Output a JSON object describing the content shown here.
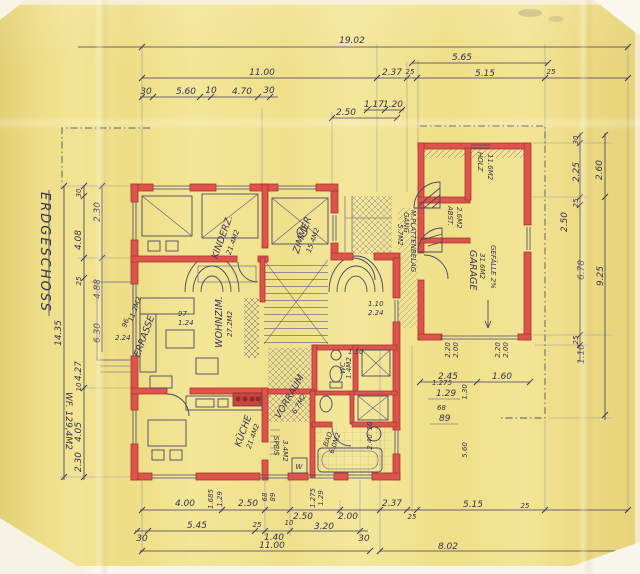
{
  "title": {
    "floor_label": "ERDGESCHOSS",
    "living_area": "WF. 129,4M2"
  },
  "rooms": {
    "kinderz": {
      "name": "KINDERZ.",
      "area": "21.4M2"
    },
    "zimmer": {
      "name": "ZIMMER",
      "area": "15.4M2"
    },
    "wohnzim": {
      "name": "WOHNZIM.",
      "area": "27.2M2"
    },
    "terrasse": {
      "name": "TERRASSE",
      "area": "11.2M2"
    },
    "kueche": {
      "name": "KÜCHE",
      "area": "21.4M2"
    },
    "speis": {
      "name": "SPEIS",
      "area": "3.4M2"
    },
    "vorraum": {
      "name": "VORRAUM",
      "area": "6.7M2"
    },
    "wc": {
      "name": "WC",
      "area": "1.4M2"
    },
    "bad": {
      "name": "BAD",
      "area": "6.0M2"
    },
    "holz": {
      "name": "HOLZ",
      "area": "11.6M2"
    },
    "abst": {
      "name": "ABST.",
      "area": "2.6M2"
    },
    "garage": {
      "name": "GARAGE",
      "area": "31.6M2",
      "slope": "GEFÄLLE 2%"
    },
    "gang": {
      "name": "GANG",
      "note": "M.PLATTENBELAG",
      "area": "5.7M2"
    },
    "washer_label": "W"
  },
  "dims": {
    "top": {
      "total": "19.02",
      "seg1": "11.00",
      "seg2": "2.37",
      "seg3": "25",
      "upper": "5.65",
      "seg4": "5.15",
      "seg5": "25",
      "sub": [
        "30",
        "5.60",
        "10",
        "4.70",
        "30"
      ],
      "sub2": [
        "1.17",
        "1.20"
      ],
      "porch": "2.50"
    },
    "bottom": {
      "row1": [
        "4.00",
        "2.50",
        "2.50",
        "2.00",
        "2.37",
        "25",
        "5.15",
        "25"
      ],
      "row2": [
        "30",
        "5.45",
        "25",
        "10",
        "3.20",
        "30"
      ],
      "row2b": "1.40",
      "row3": [
        "11.00",
        "8.02"
      ],
      "vert": [
        "1.685",
        "1.29",
        "68",
        "89",
        "1.275",
        "1.29"
      ]
    },
    "left": {
      "chain": [
        "30",
        "2.30",
        "4.08",
        "25",
        "4.88",
        "6.30",
        "4.27",
        "10",
        "4.05",
        "2.30"
      ],
      "total": "14.35"
    },
    "right": {
      "chain": [
        "30",
        "2.25",
        "25",
        "2.50",
        "6.78",
        "25",
        "1.10"
      ],
      "outer": [
        "2.60",
        "9.25"
      ]
    },
    "garage": {
      "left_top": "2.20",
      "left_bot": "2.00",
      "right_top": "2.20",
      "right_bot": "2.00",
      "bottom": [
        "2.45",
        "1.60"
      ]
    },
    "interior": {
      "a": "1.50",
      "b": "1.275",
      "c": "1.29",
      "d": "68",
      "e": "89",
      "f": "1.30",
      "g": "5.60",
      "h": "10",
      "i": "2.40",
      "j": "1.10",
      "k": "2.24",
      "l": "97",
      "m": "1.24",
      "n": "2.24",
      "o": "96"
    }
  }
}
